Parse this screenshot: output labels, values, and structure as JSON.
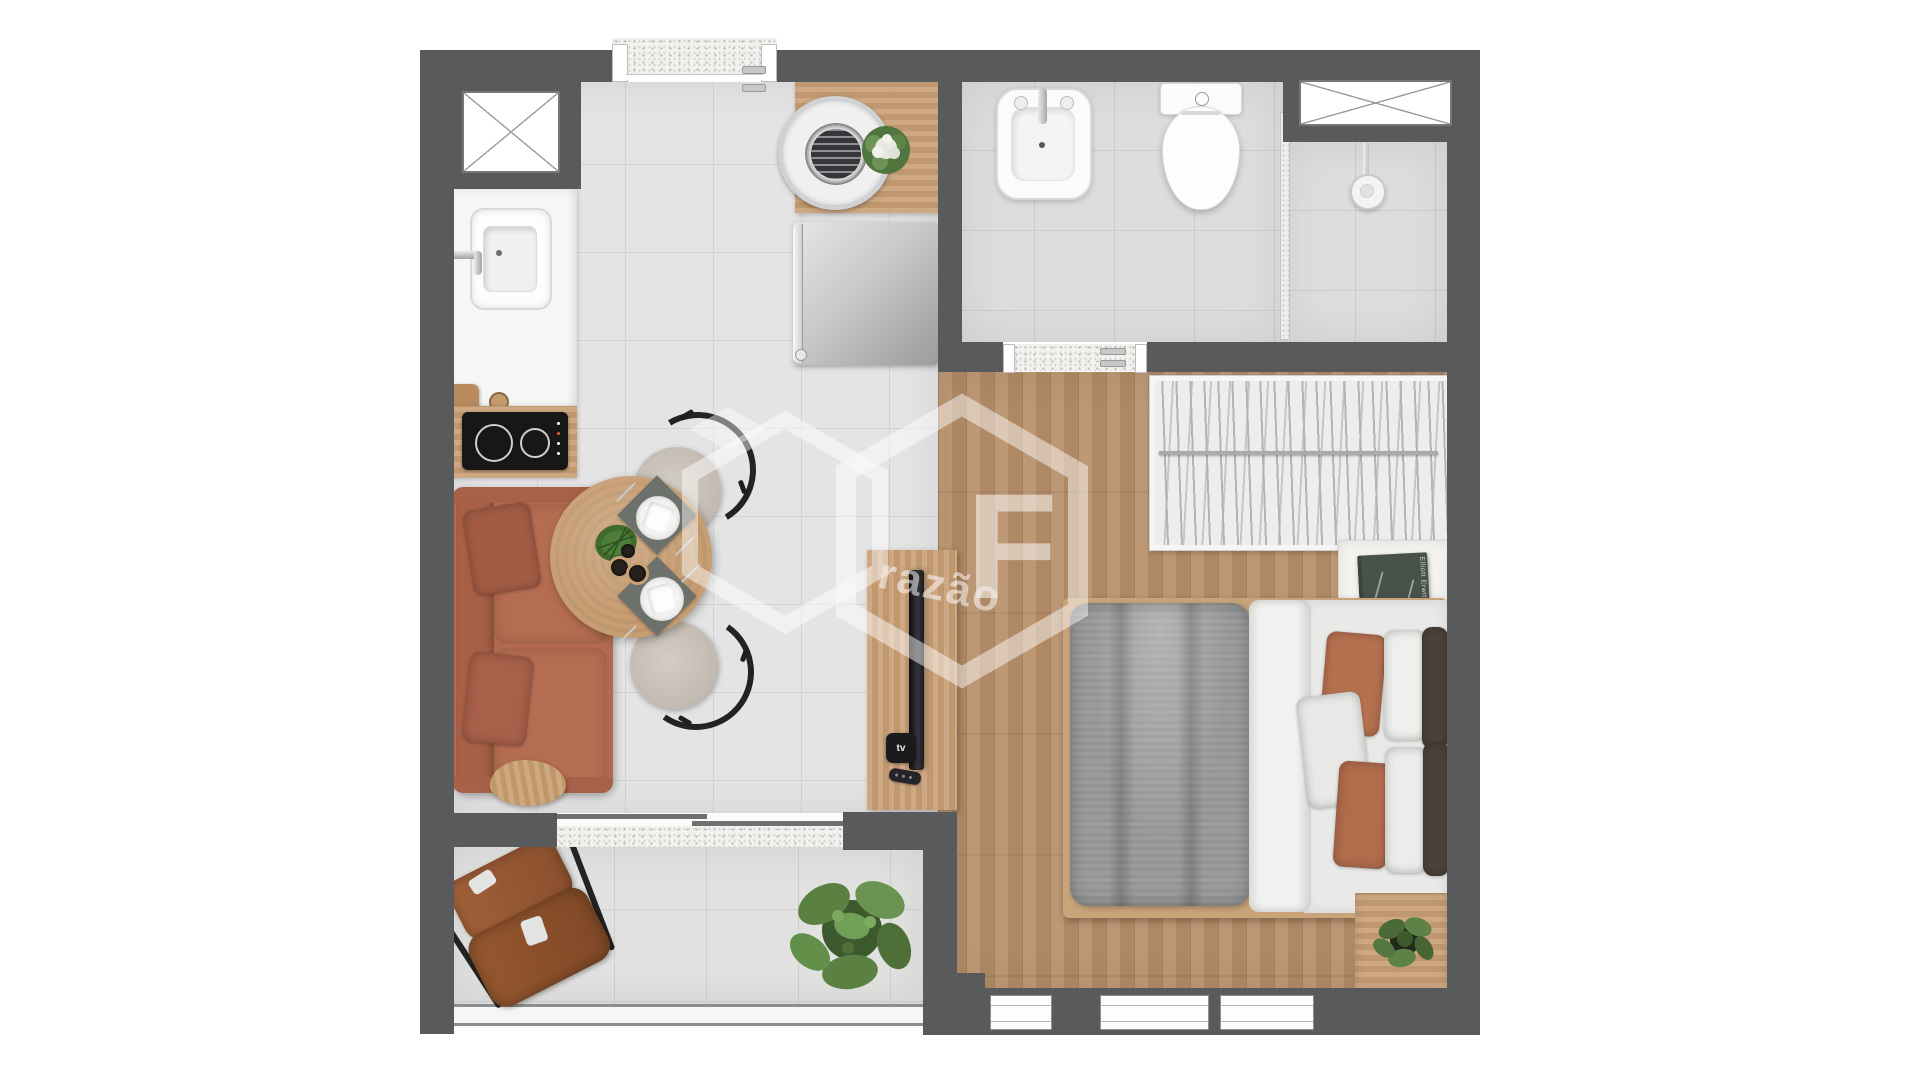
{
  "watermark": {
    "letter": "F",
    "word": "razão"
  },
  "devices": {
    "apple_tv_label": "tv"
  },
  "decor": {
    "book_title": "Elliott Erwitt Snaps"
  },
  "palette": {
    "wall": "#595a5c",
    "tile_floor": "#e4e4e4",
    "bath_floor": "#dcdddc",
    "wood_floor": "#b8906a",
    "counter_wood": "#c9a076",
    "sofa": "#b2694f",
    "sofa_pillow": "#a25c45",
    "leather": "#9a5a39",
    "duvet": "#9c9c9e",
    "terracotta": "#b5714f",
    "dark_pillow": "#4b4239",
    "plant_green": "#5f7d4a",
    "cooktop": "#171717",
    "fixture_white": "#fbfbfb",
    "watermark_white": "#ffffff"
  }
}
